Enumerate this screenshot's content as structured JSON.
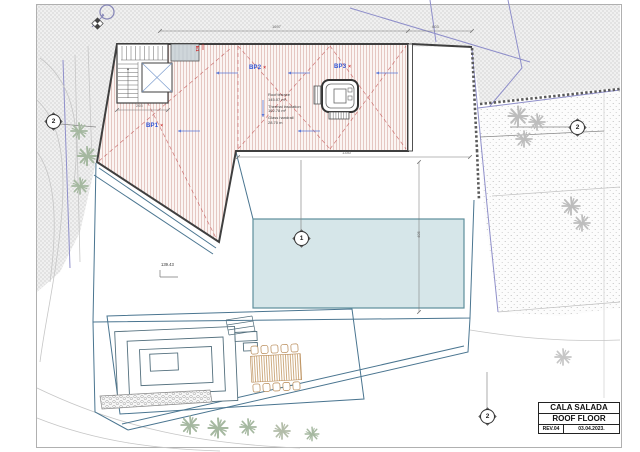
{
  "title_block": {
    "project": "CALA SALADA",
    "drawing": "ROOF FLOOR",
    "revision": "REV.04",
    "date": "03.04.2023."
  },
  "roof_labels": {
    "bp1": "BP1",
    "bp2": "BP2",
    "bp3": "BP3",
    "marker": "×",
    "stair_exit": "E1"
  },
  "area_annotations": {
    "roof_terrace_label": "Roof terrace",
    "roof_terrace_value": "145.07 m²",
    "insulation_label": "Thermal insulation",
    "insulation_value": "162.78 m²",
    "handrail_label": "Glass handrail",
    "handrail_value": "28.70 m"
  },
  "spot_elevation": "139.43",
  "dimensions": {
    "top_total": "1697",
    "top_right": "603",
    "terrace_width": "1340",
    "terrace_height": "405",
    "stair": "265"
  },
  "section_markers": {
    "left": "2",
    "right": "2",
    "center": "1",
    "bottom": "2"
  },
  "colors": {
    "bp_label_blue": "#2f54d6",
    "annotation_red": "#cc3333",
    "roof_hatch": "#dcb3ae",
    "pool_fill": "#d6e6e9",
    "pool_edge": "#5d8e9b",
    "deck_line": "#4a7590",
    "boundary_purple": "#8f8fca",
    "terrain_gray": "#e7e7e7",
    "tree_sage": "#a5b8a0",
    "tree_gray": "#bdbdbd",
    "lounger_tan": "#b5854f"
  }
}
